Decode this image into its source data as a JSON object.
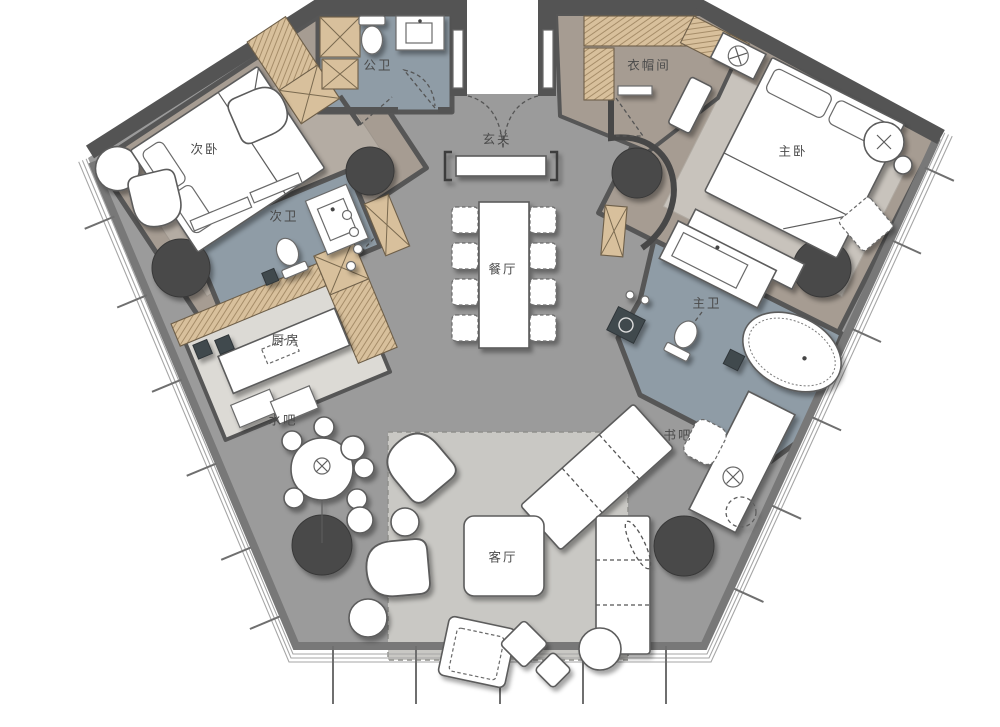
{
  "plan": {
    "type": "residential-floor-plan",
    "rooms": {
      "bedroom2": {
        "label": "次卧"
      },
      "guest_bath": {
        "label": "公卫"
      },
      "foyer": {
        "label": "玄关"
      },
      "cloakroom": {
        "label": "衣帽间"
      },
      "master_bedroom": {
        "label": "主卧"
      },
      "bath2": {
        "label": "次卫"
      },
      "kitchen": {
        "label": "厨房"
      },
      "dining": {
        "label": "餐厅"
      },
      "master_bath": {
        "label": "主卫"
      },
      "water_bar": {
        "label": "水吧"
      },
      "book_bar": {
        "label": "书吧"
      },
      "living": {
        "label": "客厅"
      }
    },
    "palette": {
      "wall": "#545454",
      "hall_floor": "#9b9b9b",
      "bedroom_floor": "#a69c92",
      "bath_floor": "#8f9ca6",
      "kitchen_floor": "#dcdad5",
      "cabinet_wood": "#d8c09c",
      "living_rug": "#c9c8c4",
      "bedroom_rug": "#b4aca3",
      "column": "#4a4a4a",
      "furniture": "#ffffff",
      "outline": "#5c5c5c",
      "glass": "#a6a6a6"
    },
    "fixtures": {
      "entry_door": "double-swing-door",
      "bed": "double-bed",
      "toilet": "toilet",
      "sink": "wash-basin",
      "bathtub": "oval-bathtub",
      "dining_table": "8-seat-dining-table",
      "kitchen_island": "kitchen-island",
      "bar_table": "round-bar-table",
      "sofa": "l-shaped-sofa",
      "coffee_table": "coffee-table",
      "desk": "writing-desk",
      "wardrobe": "hatched-wardrobe",
      "column": "structural-column"
    }
  }
}
